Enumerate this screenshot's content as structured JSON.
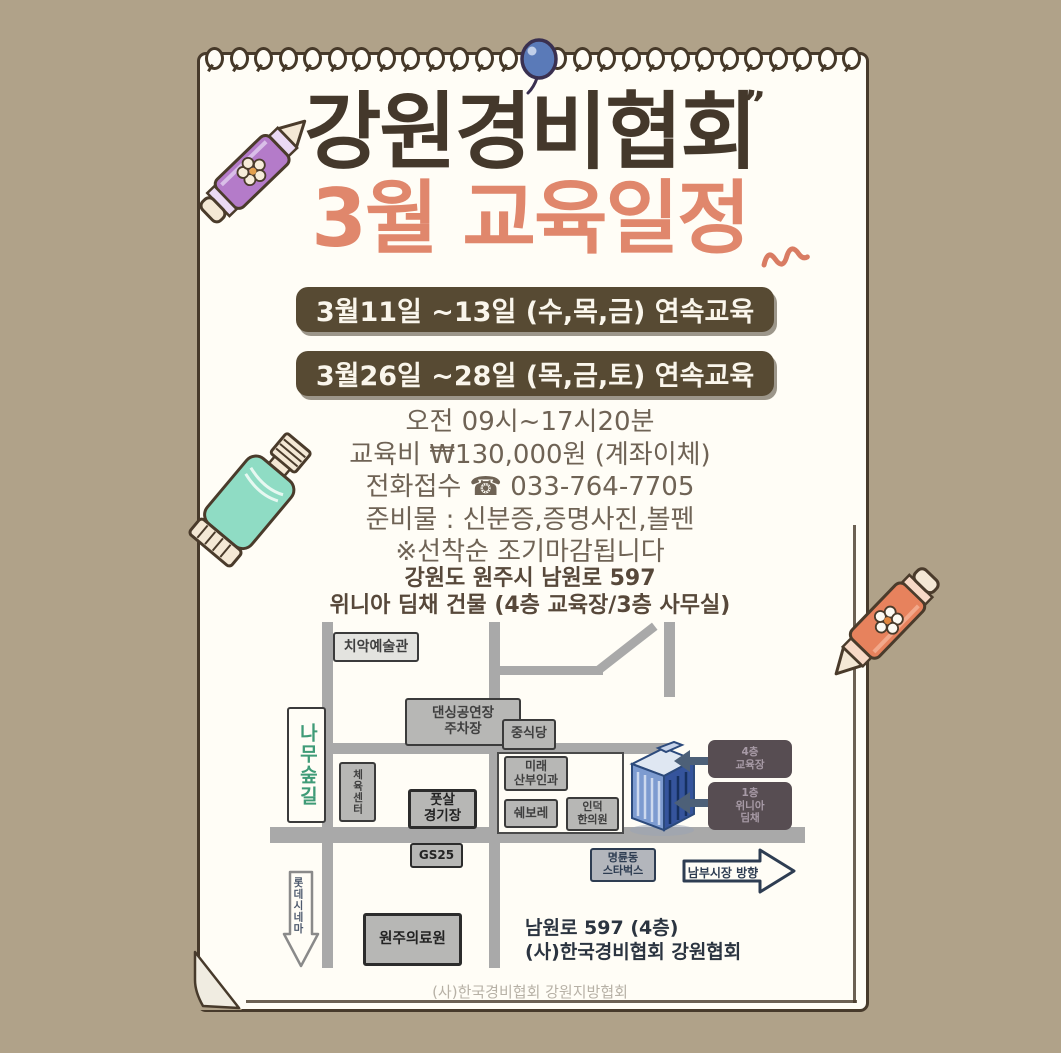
{
  "poster": {
    "title": "강원경비협회",
    "title_quote": "”",
    "subtitle": "3월 교육일정",
    "schedule_banners": [
      "3월11일 ~13일 (수,목,금) 연속교육",
      "3월26일 ~28일 (목,금,토) 연속교육"
    ],
    "info_lines": [
      "오전 09시~17시20분",
      "교육비 ₩130,000원 (계좌이체)",
      "전화접수 ☎ 033-764-7705",
      "준비물 : 신분증,증명사진,볼펜",
      "※선착순 조기마감됩니다"
    ],
    "address_lines": [
      "강원도 원주시 남원로 597",
      "위니아 딤채 건물 (4층 교육장/3층 사무실)"
    ],
    "footer": "(사)한국경비협회 강원지방협회"
  },
  "map": {
    "landmarks": {
      "art_hall": "치악예술관",
      "parking": "댄싱공연장\n주차장",
      "chinese_restaurant": "중식당",
      "tree_forest_road": "나무숲길",
      "sports_center": "체육센터",
      "obgyn": "미래\n산부인과",
      "futsal": "풋살\n경기장",
      "chevrolet": "쉐보레",
      "clinic": "인덕\n한의원",
      "gs25": "GS25",
      "lotte_cinema": "롯데시네마",
      "medical_center": "원주의료원",
      "starbucks": "명륜동\n스타벅스",
      "nambu_market": "남부시장 방향"
    },
    "building_tags": {
      "tag_top": "4층\n교육장",
      "tag_bottom": "1층\n위니아\n딤채"
    },
    "location_note": [
      "남원로 597 (4층)",
      "(사)한국경비협회 강원협회"
    ]
  },
  "colors": {
    "background": "#b0a289",
    "paper": "#fffdf6",
    "ink": "#44382b",
    "coral": "#e0876c",
    "banner_bg": "#574a33",
    "info_text": "#6f6355",
    "road_gray": "#a9a9a9",
    "map_navy": "#2e3d52",
    "building_blue": "#35549c"
  }
}
